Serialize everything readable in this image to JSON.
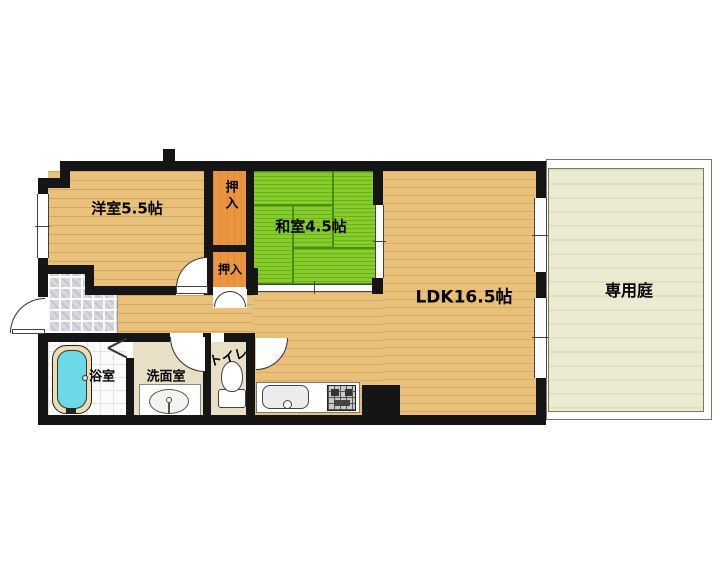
{
  "plan": {
    "rooms": {
      "western_room": {
        "label": "洋室5.5帖"
      },
      "closet_upper": {
        "label": "押入"
      },
      "closet_lower": {
        "label": "押入"
      },
      "japanese_room": {
        "label": "和室4.5帖"
      },
      "ldk": {
        "label": "LDK16.5帖"
      },
      "garden": {
        "label": "専用庭"
      },
      "bathroom": {
        "label": "浴室"
      },
      "washroom": {
        "label": "洗面室"
      },
      "toilet": {
        "label": "トイレ"
      }
    },
    "colors": {
      "wall": "#151515",
      "wood_floor": "#eac17b",
      "tatami_green": "#86cd2c",
      "closet_orange": "#ea953f",
      "garden_fill": "#ecebd1",
      "entrance_tile": "#d7d7e0",
      "wet_room_floor": "#e7dfc6",
      "bathtub_cyan": "#6ed9e6",
      "background": "#ffffff"
    }
  }
}
